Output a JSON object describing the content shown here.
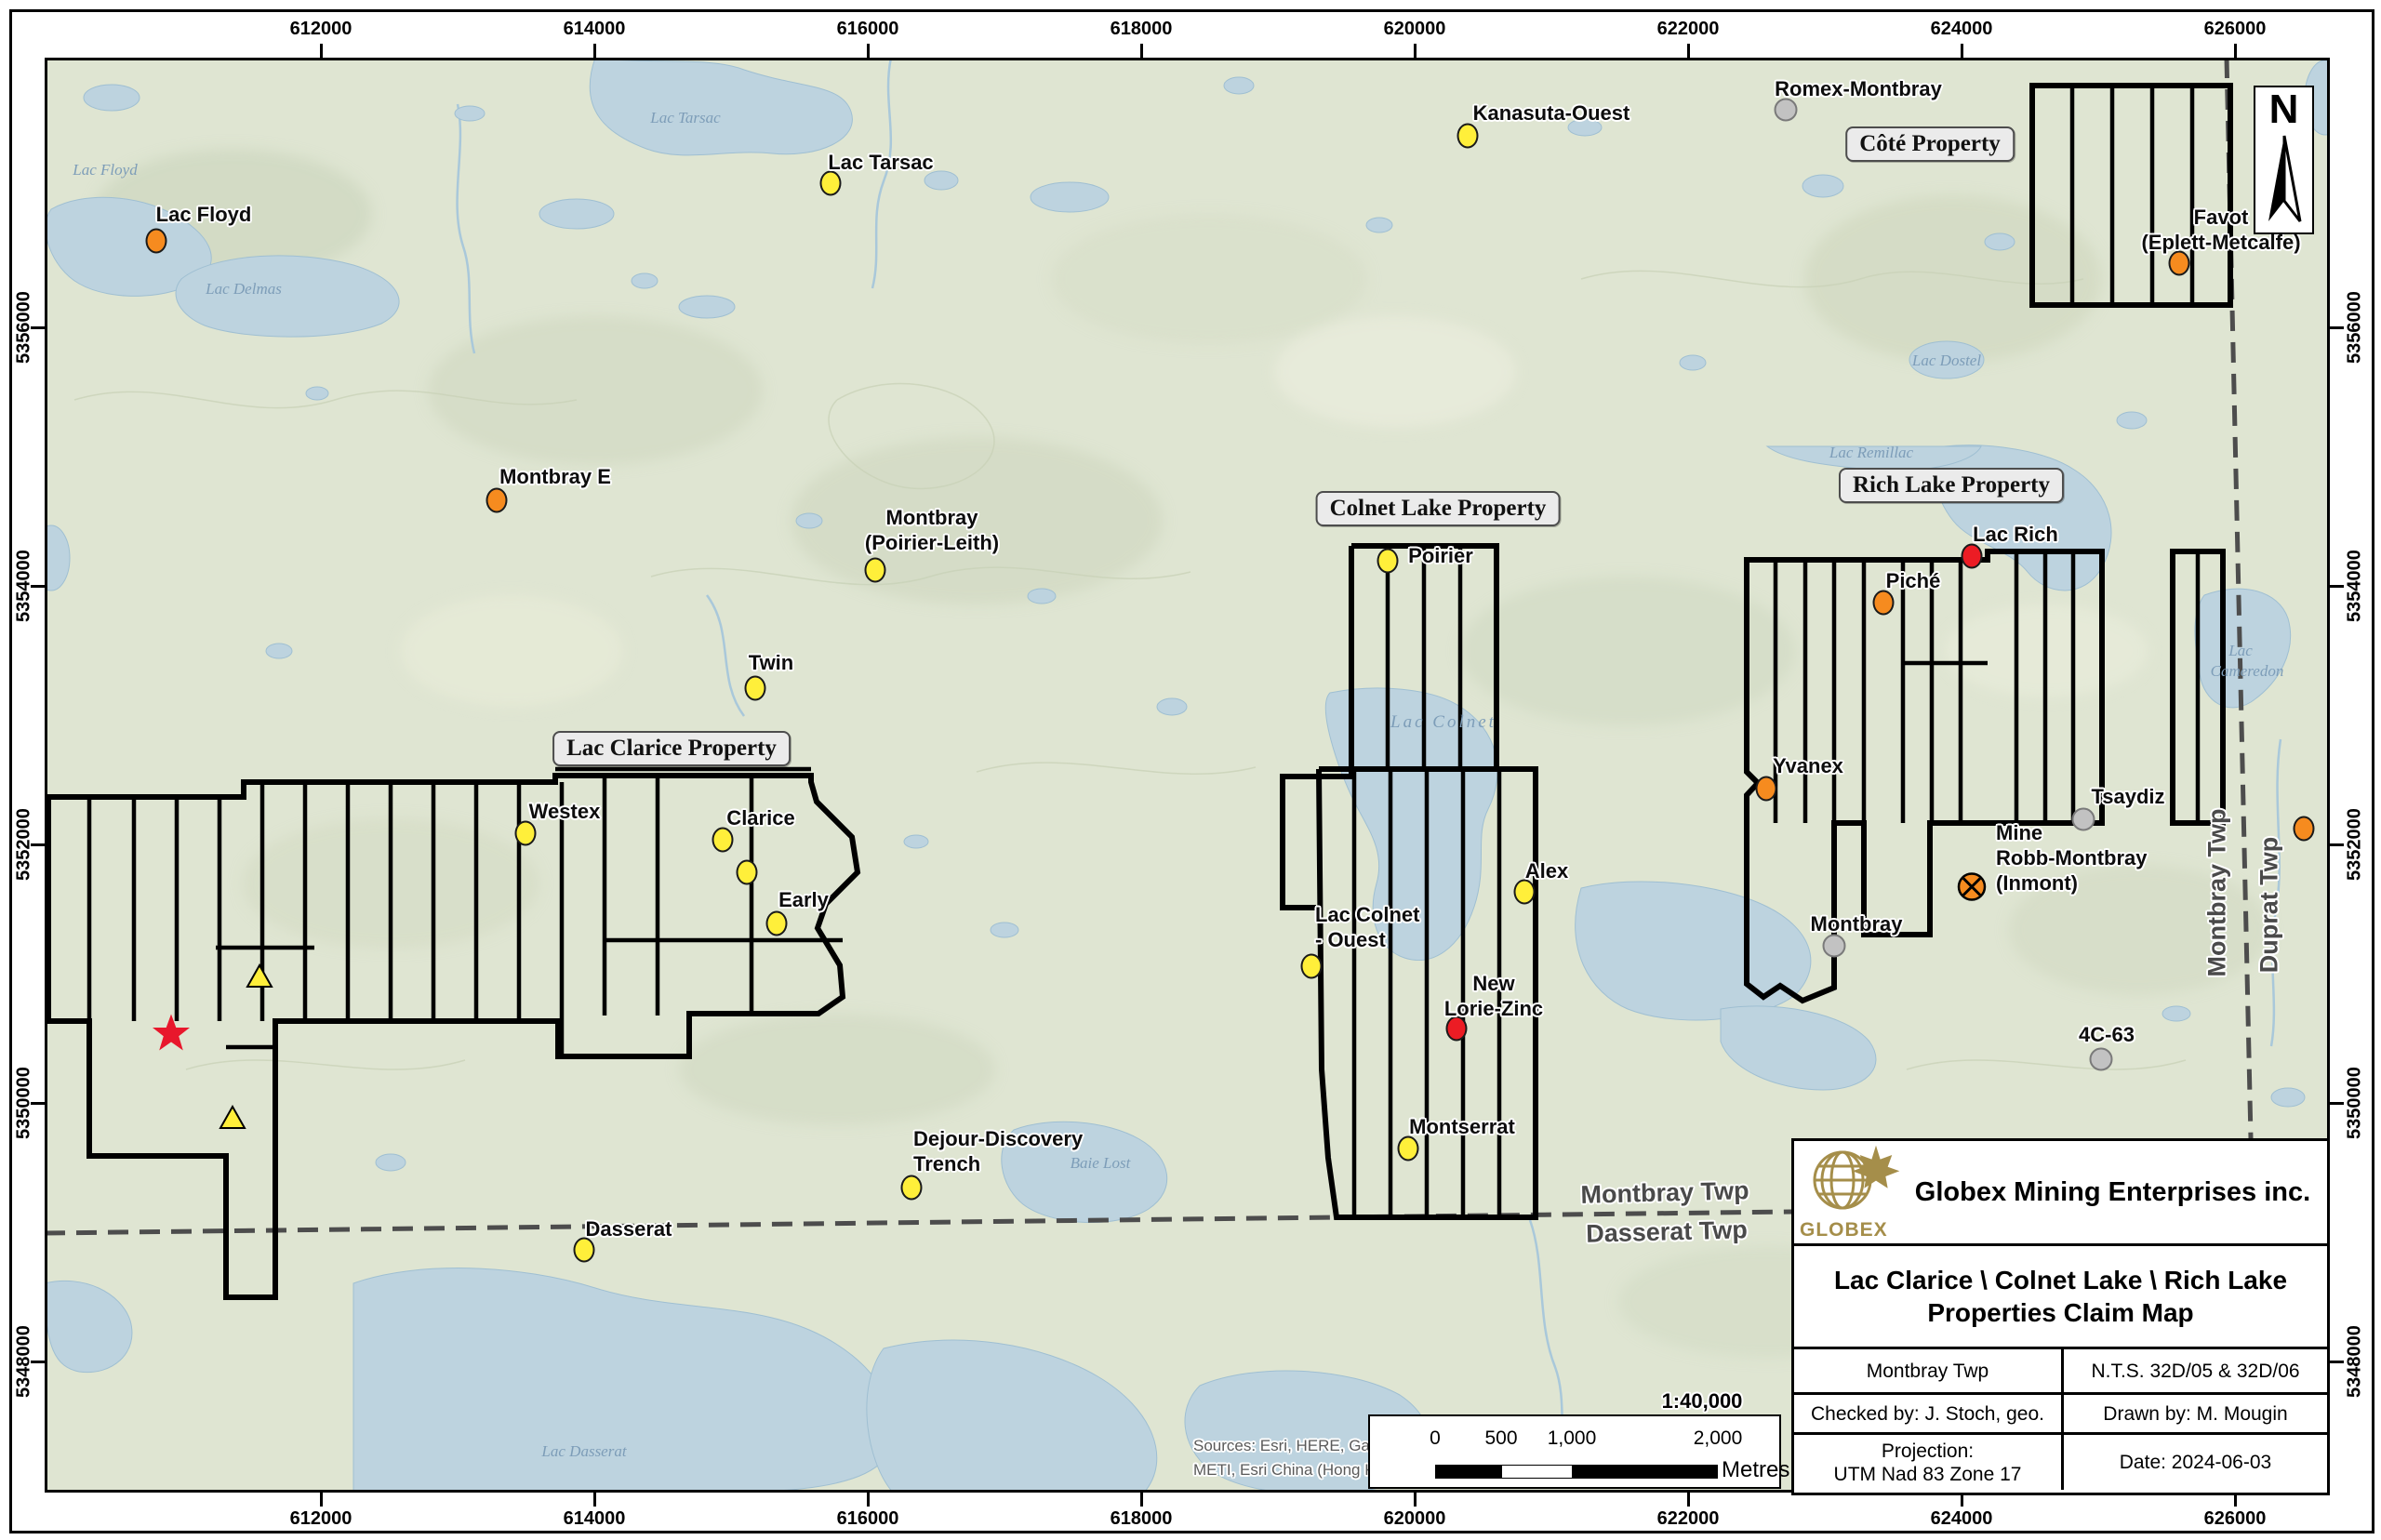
{
  "colors": {
    "yellow": "#ffef3a",
    "orange": "#f68b1f",
    "red": "#ec1c24",
    "gray": "#c2c2c2",
    "gray_stroke": "#7a7a7a",
    "marker_stroke": "#1a1a1a",
    "star_red": "#e8172c",
    "gold": "#a58e4a",
    "land": "#dfe5d2",
    "water": "#bdd3df"
  },
  "map": {
    "north_label": "N",
    "scale_ratio": "1:40,000",
    "scale_bar": {
      "ticks": [
        "0",
        "500",
        "1,000",
        "2,000"
      ],
      "unit": "Metres"
    },
    "sources": [
      "Sources: Esri, HERE, Garmin, Int",
      "METI, Esri China (Hong Kong), (c"
    ],
    "x_ticks": [
      {
        "label": "612000",
        "x": 345
      },
      {
        "label": "614000",
        "x": 639
      },
      {
        "label": "616000",
        "x": 933
      },
      {
        "label": "618000",
        "x": 1227
      },
      {
        "label": "620000",
        "x": 1521
      },
      {
        "label": "622000",
        "x": 1815
      },
      {
        "label": "624000",
        "x": 2109
      },
      {
        "label": "626000",
        "x": 2403
      }
    ],
    "y_ticks": [
      {
        "label": "5356000",
        "y": 352
      },
      {
        "label": "5354000",
        "y": 630
      },
      {
        "label": "5352000",
        "y": 908
      },
      {
        "label": "5350000",
        "y": 1186
      },
      {
        "label": "5348000",
        "y": 1464
      }
    ],
    "property_labels": [
      {
        "text": "Lac Clarice Property",
        "x": 722,
        "y": 805
      },
      {
        "text": "Colnet Lake Property",
        "x": 1546,
        "y": 547
      },
      {
        "text": "Rich Lake Property",
        "x": 2098,
        "y": 522
      },
      {
        "text": "Côté Property",
        "x": 2075,
        "y": 155
      }
    ],
    "township_labels": [
      {
        "text": "Montbray Twp",
        "x": 1790,
        "y": 1283,
        "rot": -1.5,
        "anchor": "center"
      },
      {
        "text": "Dasserat Twp",
        "x": 1792,
        "y": 1325,
        "rot": -1.5,
        "anchor": "center"
      },
      {
        "text": "Montbray Twp",
        "x": 2384,
        "y": 960,
        "rot": -90,
        "anchor": "center"
      },
      {
        "text": "Duprat Twp",
        "x": 2440,
        "y": 973,
        "rot": -90,
        "anchor": "center"
      }
    ],
    "lake_labels": [
      {
        "text": "Lac Floyd",
        "x": 113,
        "y": 183
      },
      {
        "text": "Lac Delmas",
        "x": 262,
        "y": 311
      },
      {
        "text": "Lac Tarsac",
        "x": 737,
        "y": 127
      },
      {
        "text": "Lac Colnet",
        "x": 1552,
        "y": 777,
        "spread": true
      },
      {
        "text": "Lac Remillac",
        "x": 2012,
        "y": 487
      },
      {
        "text": "Lac",
        "x": 2409,
        "y": 700
      },
      {
        "text": "Cameredon",
        "x": 2416,
        "y": 722
      },
      {
        "text": "Lac Dostel",
        "x": 2093,
        "y": 388
      },
      {
        "text": "Baie Lost",
        "x": 1183,
        "y": 1251
      },
      {
        "text": "Lac Dasserat",
        "x": 628,
        "y": 1561
      }
    ],
    "markers": [
      {
        "name": "lac-floyd",
        "type": "orange",
        "x": 168,
        "y": 259,
        "lines": [
          "Lac Floyd"
        ],
        "lx": 219,
        "ly": 230,
        "align": "center"
      },
      {
        "name": "montbray-e",
        "type": "orange",
        "x": 534,
        "y": 538,
        "lines": [
          "Montbray E"
        ],
        "lx": 597,
        "ly": 512,
        "align": "center"
      },
      {
        "name": "favot-eplett-metcalfe",
        "type": "orange",
        "x": 2343,
        "y": 283,
        "lines": [
          "Favot",
          "(Eplett-Metcalfe)"
        ],
        "lx": 2388,
        "ly": 247,
        "align": "center"
      },
      {
        "name": "piche",
        "type": "orange",
        "x": 2025,
        "y": 648,
        "lines": [
          "Piché"
        ],
        "lx": 2057,
        "ly": 624,
        "align": "center"
      },
      {
        "name": "yvanex",
        "type": "orange",
        "x": 1899,
        "y": 848,
        "lines": [
          "Yvanex"
        ],
        "lx": 1944,
        "ly": 823,
        "align": "center"
      },
      {
        "name": "unnamed-east",
        "type": "orange",
        "x": 2477,
        "y": 891,
        "lines": [],
        "lx": 0,
        "ly": 0,
        "align": "center"
      },
      {
        "name": "lac-rich",
        "type": "red",
        "x": 2120,
        "y": 598,
        "lines": [
          "Lac Rich"
        ],
        "lx": 2167,
        "ly": 574,
        "align": "center"
      },
      {
        "name": "new-lorie-zinc",
        "type": "red",
        "x": 1566,
        "y": 1106,
        "lines": [
          "New",
          "Lorie-Zinc"
        ],
        "lx": 1606,
        "ly": 1071,
        "align": "center"
      },
      {
        "name": "lac-tarsac",
        "type": "yellow",
        "x": 893,
        "y": 197,
        "lines": [
          "Lac Tarsac"
        ],
        "lx": 947,
        "ly": 174,
        "align": "center"
      },
      {
        "name": "kanasuta-ouest",
        "type": "yellow",
        "x": 1578,
        "y": 146,
        "lines": [
          "Kanasuta-Ouest"
        ],
        "lx": 1668,
        "ly": 121,
        "align": "center"
      },
      {
        "name": "montbray-poirier-leith",
        "type": "yellow",
        "x": 941,
        "y": 613,
        "lines": [
          "Montbray",
          "(Poirier-Leith)"
        ],
        "lx": 1002,
        "ly": 570,
        "align": "center"
      },
      {
        "name": "twin",
        "type": "yellow",
        "x": 812,
        "y": 740,
        "lines": [
          "Twin"
        ],
        "lx": 829,
        "ly": 712,
        "align": "center"
      },
      {
        "name": "westex",
        "type": "yellow",
        "x": 565,
        "y": 896,
        "lines": [
          "Westex"
        ],
        "lx": 607,
        "ly": 872,
        "align": "center"
      },
      {
        "name": "clarice",
        "type": "yellow",
        "x": 777,
        "y": 903,
        "lines": [
          "Clarice"
        ],
        "lx": 818,
        "ly": 879,
        "align": "center"
      },
      {
        "name": "clarice-south",
        "type": "yellow",
        "x": 803,
        "y": 938,
        "lines": [],
        "lx": 0,
        "ly": 0,
        "align": "center"
      },
      {
        "name": "early",
        "type": "yellow",
        "x": 835,
        "y": 993,
        "lines": [
          "Early"
        ],
        "lx": 864,
        "ly": 967,
        "align": "center"
      },
      {
        "name": "poirier",
        "type": "yellow",
        "x": 1492,
        "y": 603,
        "lines": [
          "Poirier"
        ],
        "lx": 1549,
        "ly": 597,
        "align": "center"
      },
      {
        "name": "lac-colnet-ouest",
        "type": "yellow",
        "x": 1410,
        "y": 1039,
        "lines": [
          "Lac Colnet",
          "- Ouest"
        ],
        "lx": 1414,
        "ly": 997,
        "align": "left"
      },
      {
        "name": "alex",
        "type": "yellow",
        "x": 1639,
        "y": 959,
        "lines": [
          "Alex"
        ],
        "lx": 1663,
        "ly": 936,
        "align": "center"
      },
      {
        "name": "montserrat",
        "type": "yellow",
        "x": 1514,
        "y": 1235,
        "lines": [
          "Montserrat"
        ],
        "lx": 1572,
        "ly": 1211,
        "align": "center"
      },
      {
        "name": "dasserat",
        "type": "yellow",
        "x": 628,
        "y": 1344,
        "lines": [
          "Dasserat"
        ],
        "lx": 676,
        "ly": 1321,
        "align": "center"
      },
      {
        "name": "dejour-discovery-trench",
        "type": "yellow",
        "x": 980,
        "y": 1277,
        "lines": [
          "Dejour-Discovery",
          "Trench"
        ],
        "lx": 982,
        "ly": 1238,
        "align": "left"
      },
      {
        "name": "romex-montbray",
        "type": "gray",
        "x": 1920,
        "y": 118,
        "lines": [
          "Romex-Montbray"
        ],
        "lx": 1998,
        "ly": 95,
        "align": "center"
      },
      {
        "name": "tsaydiz",
        "type": "gray",
        "x": 2240,
        "y": 881,
        "lines": [
          "Tsaydiz"
        ],
        "lx": 2288,
        "ly": 856,
        "align": "center"
      },
      {
        "name": "montbray",
        "type": "gray",
        "x": 1972,
        "y": 1017,
        "lines": [
          "Montbray"
        ],
        "lx": 1996,
        "ly": 993,
        "align": "center"
      },
      {
        "name": "4c-63",
        "type": "gray",
        "x": 2259,
        "y": 1139,
        "lines": [
          "4C-63"
        ],
        "lx": 2265,
        "ly": 1112,
        "align": "center"
      },
      {
        "name": "mine-robb-montbray-inmont",
        "type": "mine",
        "x": 2120,
        "y": 956,
        "lines": [
          "Mine",
          "Robb-Montbray",
          "(Inmont)"
        ],
        "lx": 2146,
        "ly": 922,
        "align": "left"
      },
      {
        "name": "showing-star",
        "type": "star",
        "x": 184,
        "y": 1113,
        "lines": [],
        "lx": 0,
        "ly": 0,
        "align": "center"
      },
      {
        "name": "showing-triangle-north",
        "type": "triangle",
        "x": 279,
        "y": 1052,
        "lines": [],
        "lx": 0,
        "ly": 0,
        "align": "center"
      },
      {
        "name": "showing-triangle-south",
        "type": "triangle",
        "x": 250,
        "y": 1204,
        "lines": [],
        "lx": 0,
        "ly": 0,
        "align": "center"
      }
    ]
  },
  "title_block": {
    "company": "Globex Mining Enterprises inc.",
    "logo_text": "GLOBEX",
    "title_line1": "Lac Clarice \\ Colnet Lake \\ Rich Lake",
    "title_line2": "Properties Claim Map",
    "township": "Montbray Twp",
    "nts": "N.T.S. 32D/05 & 32D/06",
    "checked_by": "Checked by: J. Stoch, geo.",
    "drawn_by": "Drawn by: M. Mougin",
    "projection_line1": "Projection:",
    "projection_line2": "UTM Nad 83 Zone 17",
    "date": "Date: 2024-06-03"
  }
}
